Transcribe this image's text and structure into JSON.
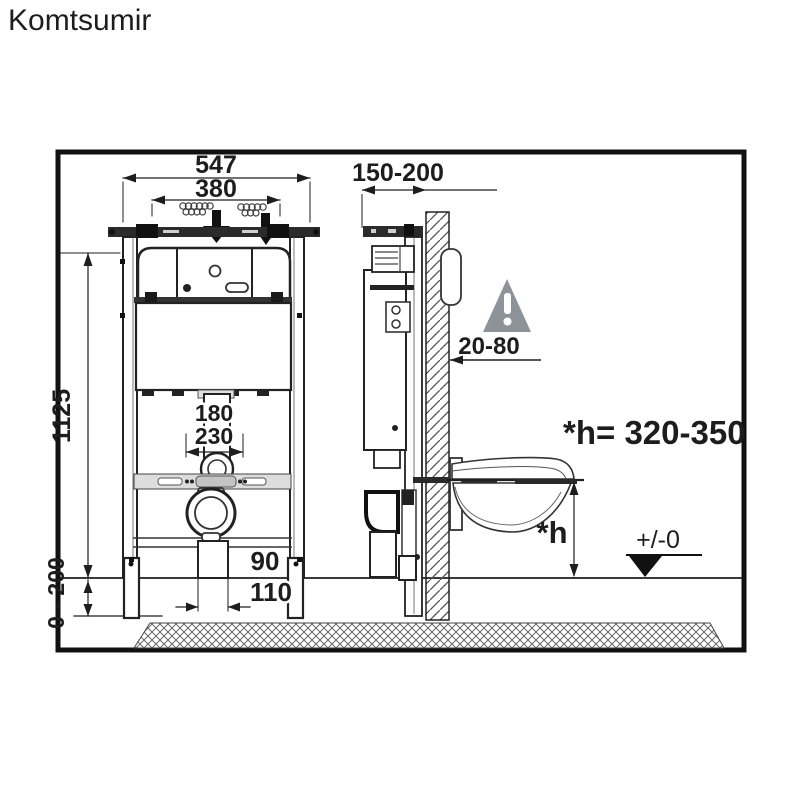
{
  "logo": {
    "text": "Komtsumir",
    "color": "#e20f0f"
  },
  "front_view": {
    "outer_width": "547",
    "inner_width": "380",
    "frame_height": "1125",
    "flush_bend_offset_top": "180",
    "flush_bend_offset_bottom": "230",
    "leg_adjustment_range": "0 - 200",
    "flush_pipe_diameter": "90",
    "drain_pipe_diameter": "110"
  },
  "side_view": {
    "mounting_depth_range": "150-200",
    "wall_finish_gap_range": "20-80",
    "seat_height_label": "*h",
    "seat_height_formula": "*h= 320-350",
    "floor_datum_label": "+/-0"
  },
  "icons": {
    "warning": "exclamation-triangle-icon",
    "datum": "floor-datum-triangle-icon",
    "mounting_arrows": "down-arrow-icon"
  },
  "colors": {
    "line": "#1d1d1d",
    "warning_gray": "#8e939a",
    "logo_red": "#e20f0f"
  }
}
